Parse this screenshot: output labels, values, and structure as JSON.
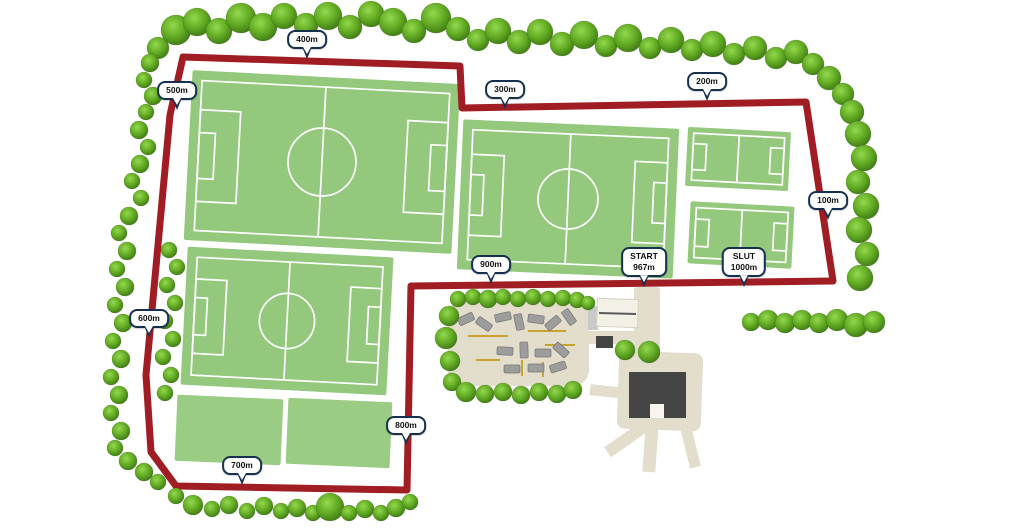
{
  "map": {
    "description_visible_text_only": true,
    "markers": [
      {
        "label": "100m"
      },
      {
        "label": "200m"
      },
      {
        "label": "300m"
      },
      {
        "label": "400m"
      },
      {
        "label": "500m"
      },
      {
        "label": "600m"
      },
      {
        "label": "700m"
      },
      {
        "label": "800m"
      },
      {
        "label": "900m"
      },
      {
        "label": "START",
        "sublabel": "967m"
      },
      {
        "label": "SLUT",
        "sublabel": "1000m"
      }
    ],
    "colors": {
      "route": "#A01D23",
      "field": "#93C87D",
      "training": "#9ACC83",
      "field_line": "#FFFFFF",
      "tree_light": "#93D94E",
      "tree_mid": "#61A922",
      "tree_dark": "#3A7413",
      "path": "#E3DDCB",
      "building_dark": "#454545",
      "building_light": "#F3F0E5",
      "car": "#9D9D9D",
      "parking_line": "#C7A32F",
      "marker_border": "#16304F",
      "marker_bg": "#FFFFFF",
      "marker_text": "#111111"
    }
  }
}
